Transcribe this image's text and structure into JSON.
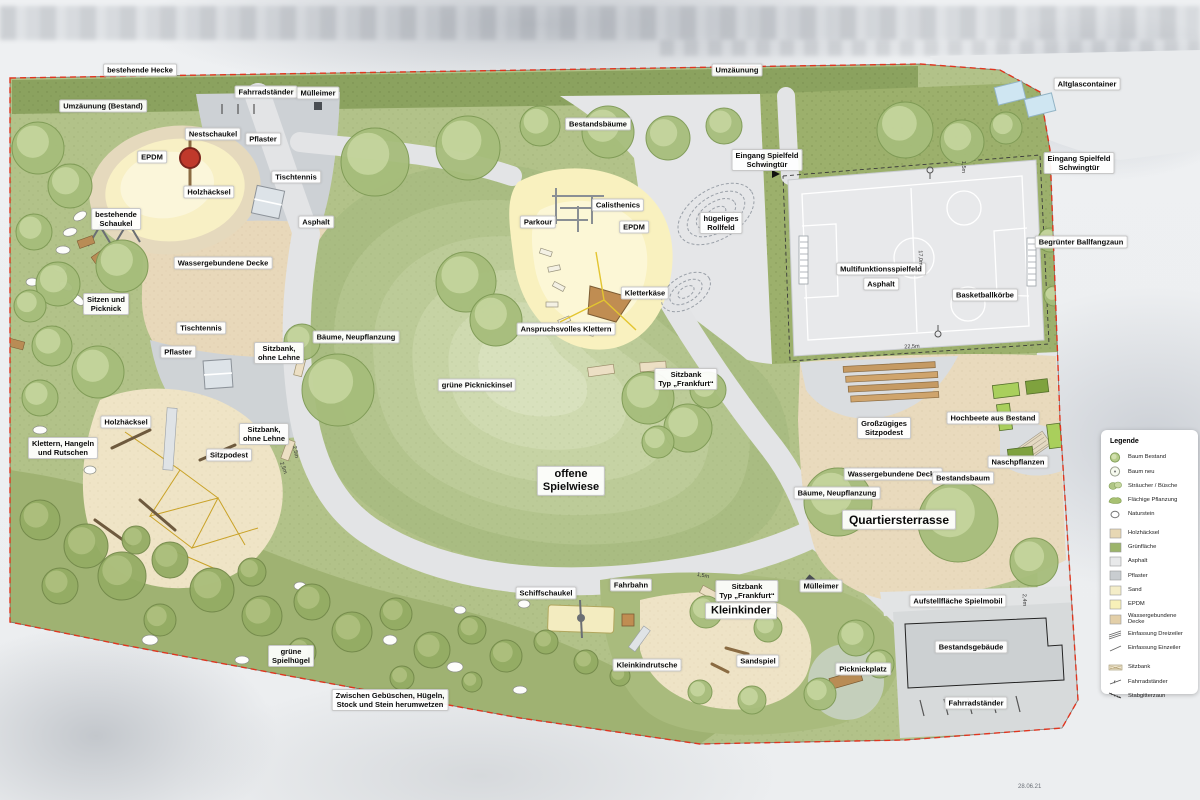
{
  "plan": {
    "date_note": "28.06.21"
  },
  "legend": {
    "title": "Legende",
    "items": [
      {
        "label": "Baum Bestand",
        "swatch": "tree-existing"
      },
      {
        "label": "Baum neu",
        "swatch": "tree-new"
      },
      {
        "label": "Sträucher / Büsche",
        "swatch": "shrubs"
      },
      {
        "label": "Flächige Pflanzung",
        "swatch": "planting"
      },
      {
        "label": "Naturstein",
        "swatch": "stone"
      },
      {
        "label": "Holzhäcksel",
        "swatch": "fill",
        "color": "#e7d7b3",
        "group": true
      },
      {
        "label": "Grünfläche",
        "swatch": "fill",
        "color": "#9cb46a"
      },
      {
        "label": "Asphalt",
        "swatch": "fill",
        "color": "#e8e9ea"
      },
      {
        "label": "Pflaster",
        "swatch": "fill",
        "color": "#c9cdd0"
      },
      {
        "label": "Sand",
        "swatch": "fill",
        "color": "#f4edc8"
      },
      {
        "label": "EPDM",
        "swatch": "fill",
        "color": "#f8f0b8"
      },
      {
        "label": "Wassergebundene Decke",
        "swatch": "fill",
        "color": "#e3cfa8"
      },
      {
        "label": "Einfassung Dreizeiler",
        "swatch": "edge3"
      },
      {
        "label": "Einfassung Einzeiler",
        "swatch": "edge1"
      },
      {
        "label": "Sitzbank",
        "swatch": "bench",
        "group": true
      },
      {
        "label": "Fahrradständer",
        "swatch": "bikestand"
      },
      {
        "label": "Stabgitterzaun",
        "swatch": "fence"
      }
    ]
  },
  "map_labels": [
    {
      "t": "bestehende Hecke",
      "x": 140,
      "y": 70
    },
    {
      "t": "Umzäunung",
      "x": 737,
      "y": 70
    },
    {
      "t": "Umzäunung (Bestand)",
      "x": 103,
      "y": 106
    },
    {
      "t": "Fahrradständer",
      "x": 266,
      "y": 92
    },
    {
      "t": "Mülleimer",
      "x": 318,
      "y": 93
    },
    {
      "t": "Altglascontainer",
      "x": 1087,
      "y": 84
    },
    {
      "t": "Bestandsbäume",
      "x": 598,
      "y": 124
    },
    {
      "t": "Nestschaukel",
      "x": 213,
      "y": 134
    },
    {
      "t": "Pflaster",
      "x": 263,
      "y": 139
    },
    {
      "t": "EPDM",
      "x": 152,
      "y": 157
    },
    {
      "t": "Eingang Spielfeld\nSchwingtür",
      "x": 767,
      "y": 160
    },
    {
      "t": "Eingang Spielfeld\nSchwingtür",
      "x": 1079,
      "y": 163
    },
    {
      "t": "Tischtennis",
      "x": 296,
      "y": 177
    },
    {
      "t": "Holzhäcksel",
      "x": 209,
      "y": 192
    },
    {
      "t": "Calisthenics",
      "x": 618,
      "y": 205
    },
    {
      "t": "bestehende\nSchaukel",
      "x": 116,
      "y": 219
    },
    {
      "t": "Asphalt",
      "x": 316,
      "y": 222
    },
    {
      "t": "Parkour",
      "x": 538,
      "y": 222
    },
    {
      "t": "EPDM",
      "x": 634,
      "y": 227
    },
    {
      "t": "hügeliges\nRollfeld",
      "x": 721,
      "y": 223
    },
    {
      "t": "Begrünter Ballfangzaun",
      "x": 1081,
      "y": 242
    },
    {
      "t": "Wassergebundene Decke",
      "x": 223,
      "y": 263
    },
    {
      "t": "Multifunktionsspielfeld",
      "x": 881,
      "y": 269
    },
    {
      "t": "Asphalt",
      "x": 881,
      "y": 284
    },
    {
      "t": "Kletterkäse",
      "x": 645,
      "y": 293
    },
    {
      "t": "Basketballkörbe",
      "x": 985,
      "y": 295
    },
    {
      "t": "Sitzen und\nPicknick",
      "x": 106,
      "y": 304
    },
    {
      "t": "Tischtennis",
      "x": 201,
      "y": 328
    },
    {
      "t": "Anspruchsvolles Klettern",
      "x": 566,
      "y": 329
    },
    {
      "t": "Bäume, Neupflanzung",
      "x": 356,
      "y": 337
    },
    {
      "t": "Pflaster",
      "x": 178,
      "y": 352
    },
    {
      "t": "Sitzbank,\nohne Lehne",
      "x": 279,
      "y": 353
    },
    {
      "t": "Sitzbank\nTyp „Frankfurt“",
      "x": 686,
      "y": 379
    },
    {
      "t": "grüne Picknickinsel",
      "x": 477,
      "y": 385
    },
    {
      "t": "Hochbeete aus Bestand",
      "x": 993,
      "y": 418
    },
    {
      "t": "Großzügiges\nSitzpodest",
      "x": 884,
      "y": 428
    },
    {
      "t": "Holzhäcksel",
      "x": 126,
      "y": 422
    },
    {
      "t": "Sitzbank,\nohne Lehne",
      "x": 264,
      "y": 434
    },
    {
      "t": "Klettern, Hangeln\nund Rutschen",
      "x": 63,
      "y": 448
    },
    {
      "t": "Sitzpodest",
      "x": 229,
      "y": 455
    },
    {
      "t": "Naschpflanzen",
      "x": 1018,
      "y": 462
    },
    {
      "t": "offene\nSpielwiese",
      "x": 571,
      "y": 481,
      "s": "l"
    },
    {
      "t": "Wassergebundene Decke",
      "x": 893,
      "y": 474
    },
    {
      "t": "Bestandsbaum",
      "x": 963,
      "y": 478
    },
    {
      "t": "Bäume, Neupflanzung",
      "x": 837,
      "y": 493
    },
    {
      "t": "Quartiersterrasse",
      "x": 899,
      "y": 520,
      "s": "xl"
    },
    {
      "t": "Fahrbahn",
      "x": 631,
      "y": 585
    },
    {
      "t": "Schiffschaukel",
      "x": 546,
      "y": 593
    },
    {
      "t": "Sitzbank\nTyp „Frankfurt“",
      "x": 747,
      "y": 591
    },
    {
      "t": "Mülleimer",
      "x": 821,
      "y": 586
    },
    {
      "t": "Aufstellfläche Spielmobil",
      "x": 958,
      "y": 601
    },
    {
      "t": "Kleinkinder",
      "x": 741,
      "y": 611,
      "s": "l"
    },
    {
      "t": "Bestandsgebäude",
      "x": 971,
      "y": 647
    },
    {
      "t": "grüne\nSpielhügel",
      "x": 291,
      "y": 656
    },
    {
      "t": "Kleinkindrutsche",
      "x": 647,
      "y": 665
    },
    {
      "t": "Sandspiel",
      "x": 758,
      "y": 661
    },
    {
      "t": "Picknickplatz",
      "x": 863,
      "y": 669
    },
    {
      "t": "Zwischen Gebüschen, Hügeln,\nStock und Stein herumwetzen",
      "x": 390,
      "y": 700
    },
    {
      "t": "Fahrradständer",
      "x": 976,
      "y": 703
    }
  ],
  "dimensions": [
    {
      "t": "2,5m",
      "x": 295,
      "y": 452,
      "r": 78
    },
    {
      "t": "2,5m",
      "x": 283,
      "y": 468,
      "r": 70
    },
    {
      "t": "1,5m",
      "x": 963,
      "y": 167,
      "r": 90
    },
    {
      "t": "17,0m",
      "x": 920,
      "y": 258,
      "r": 88
    },
    {
      "t": "22,5m",
      "x": 912,
      "y": 347,
      "r": -3
    },
    {
      "t": "1,5m",
      "x": 703,
      "y": 576,
      "r": 12
    },
    {
      "t": "2,4m",
      "x": 1024,
      "y": 600,
      "r": 88
    }
  ]
}
